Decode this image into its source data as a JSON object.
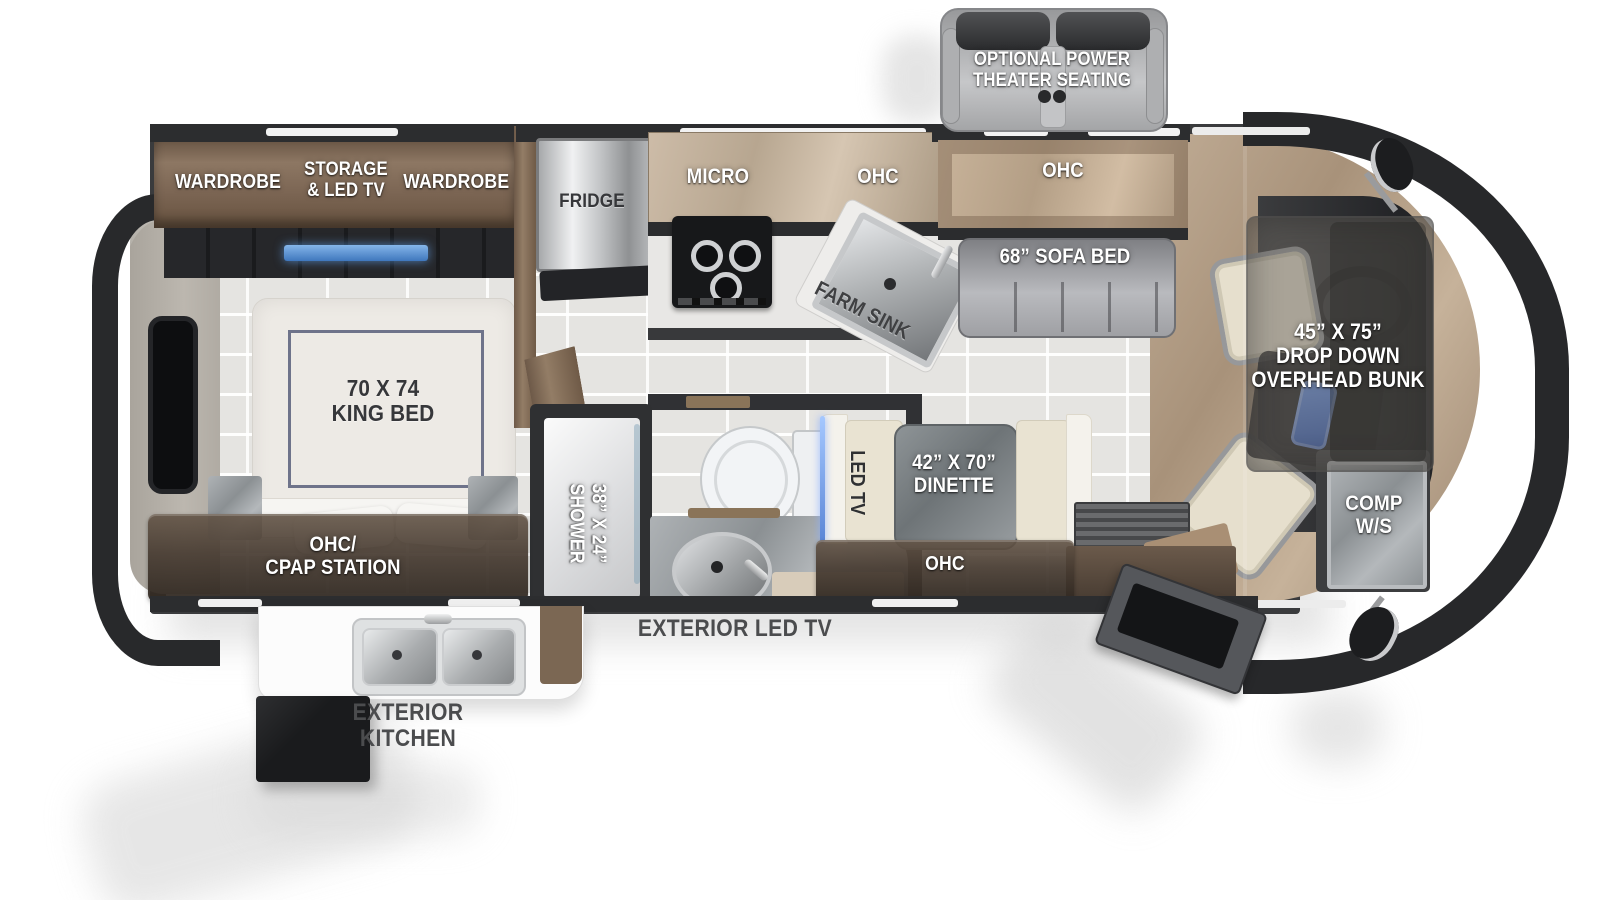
{
  "type": "rv-floorplan-diagram",
  "colors": {
    "wall": "#38393b",
    "cap": "#27282a",
    "wood_cabinet": "#8a7360",
    "marble_cabinet": "#c7b5a0",
    "glossy_brown": "#574a3e",
    "tile_floor": "#e5e4e1",
    "granite": "#979b9e",
    "accent_blue": "#4d7fd0",
    "label_white": "#ffffff",
    "label_dark": "#36373a",
    "label_gray": "#4b4c4e"
  },
  "labels": {
    "theater": [
      "OPTIONAL POWER",
      "THEATER SEATING"
    ],
    "wardrobe_left": "WARDROBE",
    "storage_tv": [
      "STORAGE",
      "& LED TV"
    ],
    "wardrobe_right": "WARDROBE",
    "fridge": "FRIDGE",
    "micro": "MICRO",
    "ohc_kitchen": "OHC",
    "ohc_sofa": "OHC",
    "sofa": "68” SOFA BED",
    "farm_sink": "FARM SINK",
    "bunk": [
      "45” X 75”",
      "DROP DOWN",
      "OVERHEAD BUNK"
    ],
    "king_bed": [
      "70 X 74",
      "KING BED"
    ],
    "cpap": [
      "OHC/",
      "CPAP STATION"
    ],
    "shower": [
      "38” X 24”",
      "SHOWER"
    ],
    "led_tv": "LED TV",
    "dinette": [
      "42” X 70”",
      "DINETTE"
    ],
    "ohc_dinette": "OHC",
    "comp_ws": [
      "COMP",
      "W/S"
    ],
    "exterior_led_tv": "EXTERIOR LED TV",
    "exterior_kitchen": [
      "EXTERIOR",
      "KITCHEN"
    ]
  }
}
